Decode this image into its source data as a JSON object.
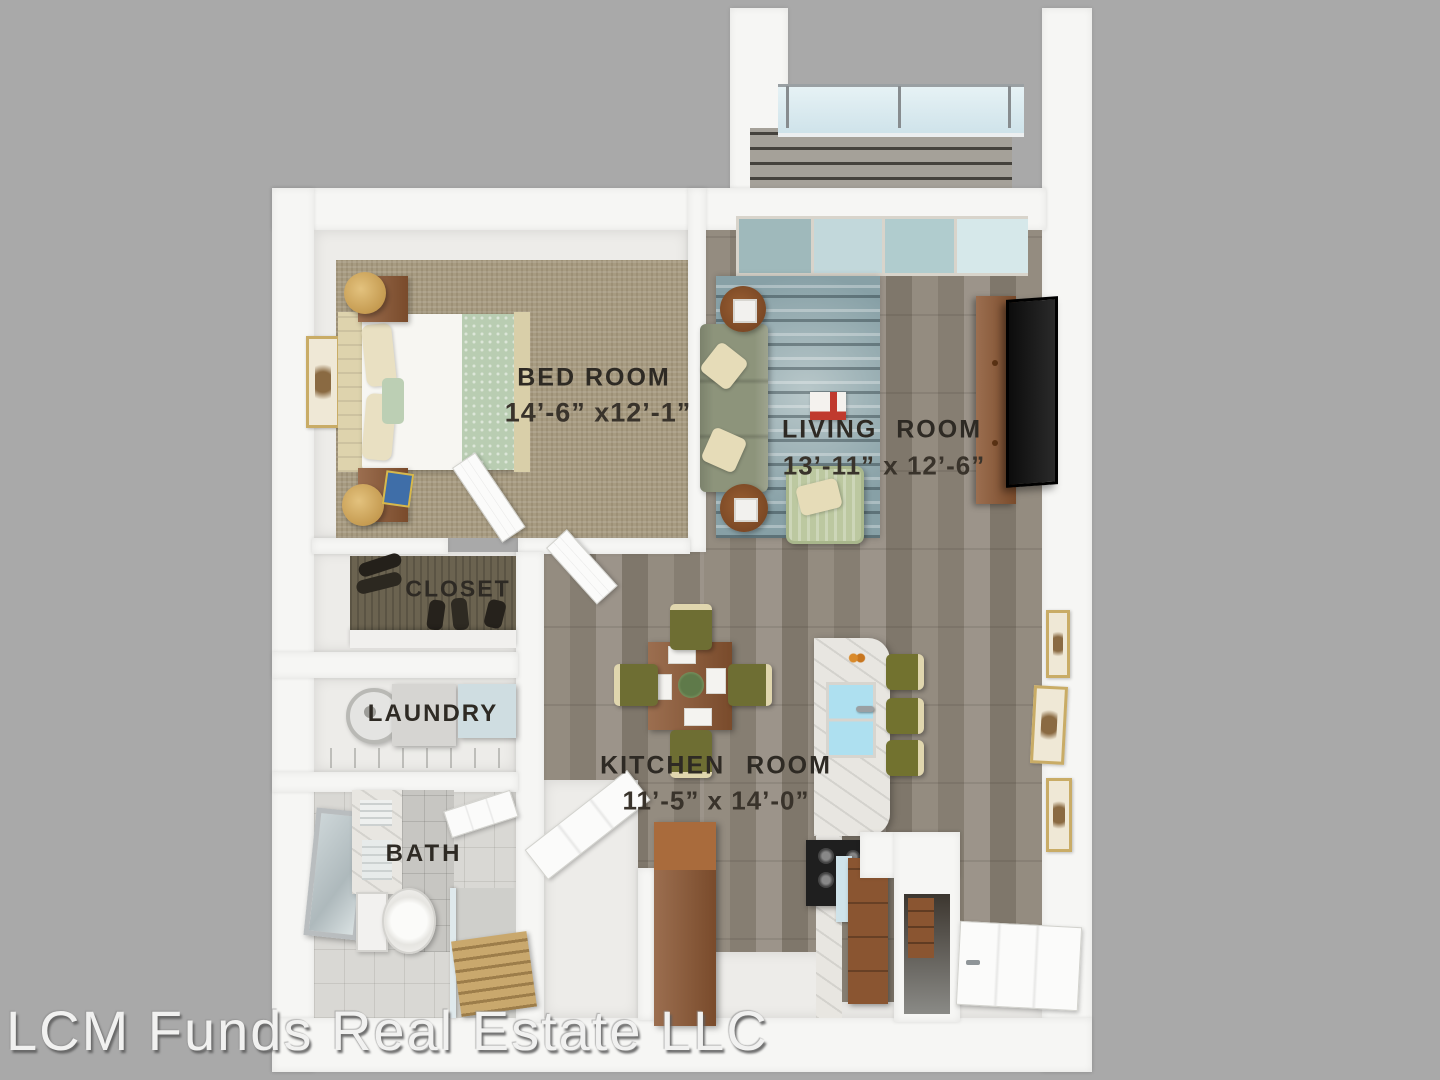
{
  "watermark": {
    "text": "LCM Funds Real Estate LLC"
  },
  "rooms": {
    "bedroom": {
      "label": "BED ROOM",
      "dimensions": "14’-6” x12’-1”"
    },
    "living": {
      "label": "LIVING ROOM",
      "dimensions": "13’-11” x 12’-6”"
    },
    "kitchen": {
      "label": "KITCHEN ROOM",
      "dimensions": "11’-5” x 14’-0”"
    },
    "closet": {
      "label": "CLOSET"
    },
    "laundry": {
      "label": "LAUNDRY"
    },
    "bath": {
      "label": "BATH"
    }
  },
  "palette": {
    "background": "#a9a9a9",
    "wall": "#f6f6f4",
    "wood_floor": "#8f877b",
    "bedroom_carpet": "#a79b81",
    "balcony_deck": "#9e9a92",
    "glass": "#cfe3ea",
    "rug": "#87a0a6",
    "sofa": "#8d947b",
    "armchair": "#bcc8a0",
    "wood_furniture": "#8a5531",
    "chair_olive": "#6e6e33",
    "label_text": "#2e2a24",
    "watermark_text": "#f1f1f0"
  }
}
